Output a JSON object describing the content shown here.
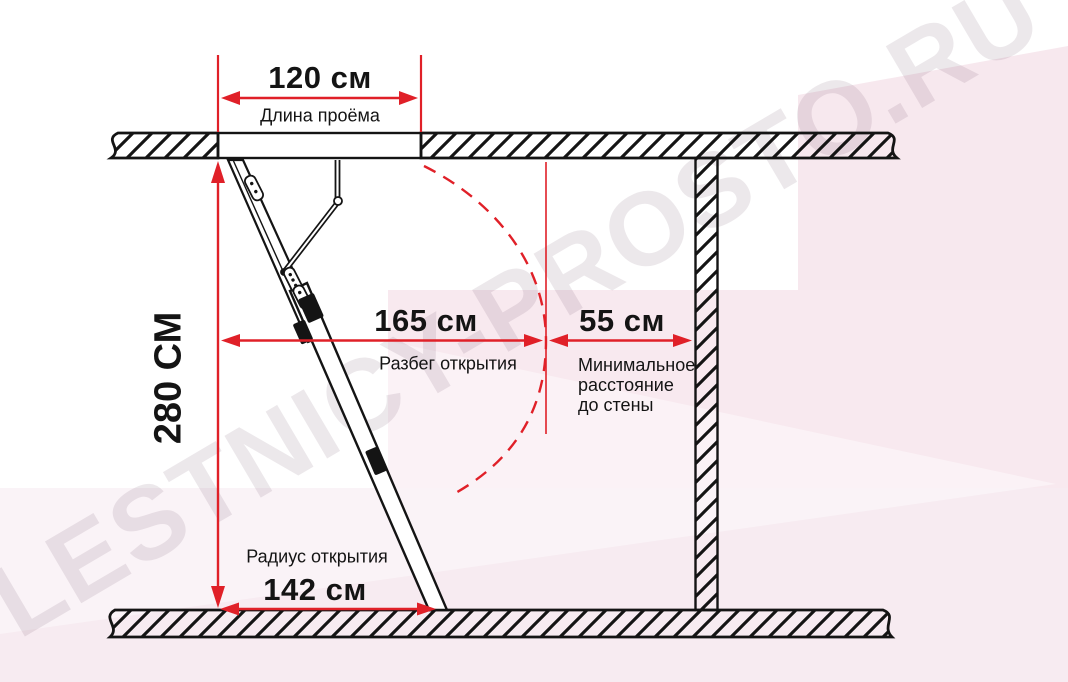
{
  "meta": {
    "title": "Схема размеров проёма чердачной лестницы",
    "diagram_type": "attic-ladder installation side-view"
  },
  "watermark": {
    "text": "LESTNICY-PROSTO.RU"
  },
  "colors": {
    "dimension_red": "#e02028",
    "ink_black": "#141414",
    "background_pink": "#f7e8ee",
    "watermark_gray": "rgba(100,66,88,0.12)"
  },
  "dimensions": {
    "opening_length": {
      "value": "120 см",
      "label": "Длина проёма"
    },
    "ceiling_height": {
      "value": "280 СМ"
    },
    "opening_span": {
      "value": "165 см",
      "label": "Разбег открытия"
    },
    "wall_distance": {
      "value": "55 см",
      "label": "Минимальное\nрасстояние\nдо стены"
    },
    "opening_radius": {
      "value": "142 см",
      "label": "Радиус открытия"
    }
  }
}
